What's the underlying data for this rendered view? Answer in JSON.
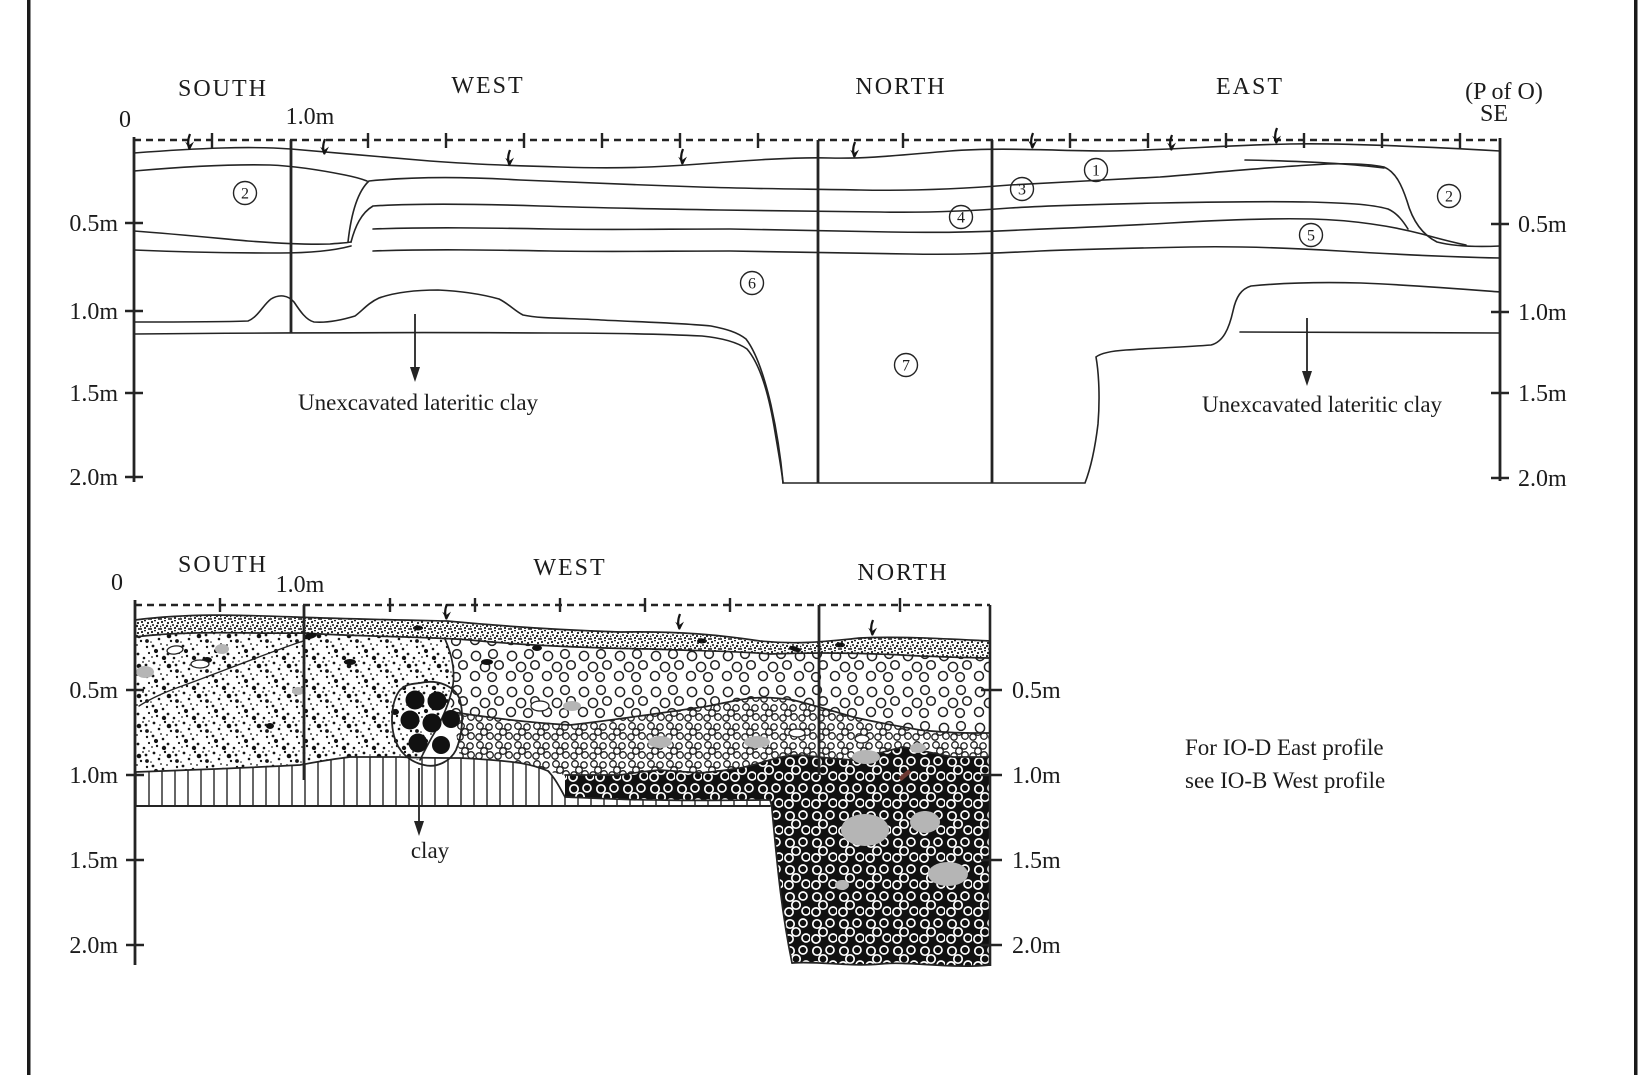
{
  "top_profile": {
    "walls": {
      "south": "SOUTH",
      "west": "WEST",
      "north": "NORTH",
      "east": "EAST"
    },
    "origin_label": "(P of O)",
    "origin_corner": "SE",
    "origin_tick": "0",
    "meter_mark": "1.0m",
    "depth_labels": [
      "0.5m",
      "1.0m",
      "1.5m",
      "2.0m"
    ],
    "layer_numbers": [
      "1",
      "2",
      "3",
      "4",
      "5",
      "6",
      "7"
    ],
    "annotation_unexcavated": "Unexcavated lateritic clay"
  },
  "bottom_profile": {
    "walls": {
      "south": "SOUTH",
      "west": "WEST",
      "north": "NORTH"
    },
    "origin_tick": "0",
    "meter_mark": "1.0m",
    "depth_labels": [
      "0.5m",
      "1.0m",
      "1.5m",
      "2.0m"
    ],
    "annotation_clay": "clay",
    "note": {
      "line1": "For IO-D East profile",
      "line2": "see IO-B West profile"
    }
  }
}
